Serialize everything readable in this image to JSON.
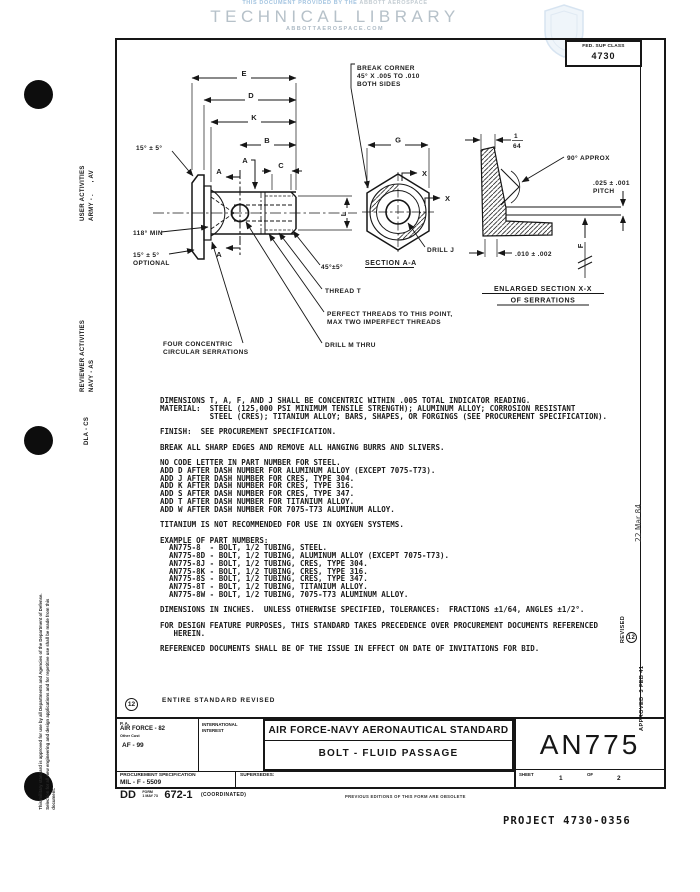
{
  "watermark": {
    "provided_prefix": "THIS DOCUMENT PROVIDED BY THE",
    "provided_brand": "ABBOTT AEROSPACE",
    "title": "TECHNICAL LIBRARY",
    "url": "ABBOTTAEROSPACE.COM"
  },
  "fed_class": {
    "label": "FED. SUP CLASS",
    "value": "4730"
  },
  "drawing": {
    "dims": {
      "e": "E",
      "d": "D",
      "k": "K",
      "b": "B",
      "a": "A",
      "c": "C",
      "g": "G",
      "l": "L",
      "f": "F",
      "x": "X",
      "frac_num": "1",
      "frac_den": "64"
    },
    "callouts": {
      "angle_head": "15° ± 5°",
      "angle_min": "118° MIN",
      "angle_opt1": "15° ± 5°",
      "angle_opt2": "OPTIONAL",
      "serr1": "FOUR CONCENTRIC",
      "serr2": "CIRCULAR SERRATIONS",
      "drill_m": "DRILL  M THRU",
      "perfect1": "PERFECT THREADS TO THIS POINT,",
      "perfect2": "MAX TWO IMPERFECT THREADS",
      "thread_t": "THREAD T",
      "tip_chamfer": "45°±5°",
      "section_a_label": "A",
      "section_aa": "SECTION A-A",
      "drill_j": "DRILL J",
      "break1": "BREAK CORNER",
      "break2": "45° X .005 TO .010",
      "break3": "BOTH SIDES",
      "approx": "90° APPROX",
      "pitch1": ".025 ± .001",
      "pitch2": "PITCH",
      "serr_w": ".010 ± .002",
      "enlarged1": "ENLARGED SECTION X-X",
      "enlarged2": "OF SERRATIONS"
    }
  },
  "notes_text": "DIMENSIONS T, A, F, AND J SHALL BE CONCENTRIC WITHIN .005 TOTAL INDICATOR READING.\nMATERIAL:  STEEL (125,000 PSI MINIMUM TENSILE STRENGTH); ALUMINUM ALLOY; CORROSION RESISTANT\n           STEEL (CRES); TITANIUM ALLOY; BARS, SHAPES, OR FORGINGS (SEE PROCUREMENT SPECIFICATION).\n\nFINISH:  SEE PROCUREMENT SPECIFICATION.\n\nBREAK ALL SHARP EDGES AND REMOVE ALL HANGING BURRS AND SLIVERS.\n\nNO CODE LETTER IN PART NUMBER FOR STEEL.\nADD D AFTER DASH NUMBER FOR ALUMINUM ALLOY (EXCEPT 7075-T73).\nADD J AFTER DASH NUMBER FOR CRES, TYPE 304.\nADD K AFTER DASH NUMBER FOR CRES, TYPE 316.\nADD S AFTER DASH NUMBER FOR CRES, TYPE 347.\nADD T AFTER DASH NUMBER FOR TITANIUM ALLOY.\nADD W AFTER DASH NUMBER FOR 7075-T73 ALUMINUM ALLOY.\n\nTITANIUM IS NOT RECOMMENDED FOR USE IN OXYGEN SYSTEMS.\n\nEXAMPLE OF PART NUMBERS:\n  AN775-8  - BOLT, 1/2 TUBING, STEEL.\n  AN775-8D - BOLT, 1/2 TUBING, ALUMINUM ALLOY (EXCEPT 7075-T73).\n  AN775-8J - BOLT, 1/2 TUBING, CRES, TYPE 304.\n  AN775-8K - BOLT, 1/2 TUBING, CRES, TYPE 316.\n  AN775-8S - BOLT, 1/2 TUBING, CRES, TYPE 347.\n  AN775-8T - BOLT, 1/2 TUBING, TITANIUM ALLOY.\n  AN775-8W - BOLT, 1/2 TUBING, 7075-T73 ALUMINUM ALLOY.\n\nDIMENSIONS IN INCHES.  UNLESS OTHERWISE SPECIFIED, TOLERANCES:  FRACTIONS ±1/64, ANGLES ±1/2°.\n\nFOR DESIGN FEATURE PURPOSES, THIS STANDARD TAKES PRECEDENCE OVER PROCUREMENT DOCUMENTS REFERENCED\n   HEREIN.\n\nREFERENCED DOCUMENTS SHALL BE OF THE ISSUE IN EFFECT ON DATE OF INVITATIONS FOR BID.",
  "revision_note": {
    "number": "12",
    "text": "ENTIRE STANDARD REVISED"
  },
  "title_block": {
    "pa_label": "P. A.",
    "pa_value": "AIR FORCE - 82",
    "other_label": "Other Cust",
    "other_value": "AF - 99",
    "intl1": "INTERNATIONAL",
    "intl2": "INTEREST",
    "standard": "AIR FORCE-NAVY AERONAUTICAL STANDARD",
    "part": "BOLT - FLUID PASSAGE",
    "number": "AN775",
    "sheet_label": "SHEET",
    "sheet": "1",
    "of_label": "OF",
    "total": "2",
    "proc_label": "PROCUREMENT SPECIFICATION",
    "proc_value": "MIL - F - 5509",
    "supersedes": "SUPERSEDES:"
  },
  "footer": {
    "dd": "DD",
    "form_line1": "FORM",
    "form_line2": "1 MAY 73",
    "form_num": "672-1",
    "coordinated": "(COORDINATED)",
    "previous": "PREVIOUS EDITIONS OF THIS FORM ARE OBSOLETE",
    "project": "PROJECT 4730-0356"
  },
  "margins": {
    "user": "USER ACTIVITIES\nARMY - .      , AV",
    "reviewer": "REVIEWER ACTIVITIES\nNAVY - AS",
    "dla": "DLA - CS",
    "statement": "This military standard is approved for use by all Departments and Agencies of the Department of Defense.\nSelection for all new engineering and design applications and for repetitive use shall be made from this\ndocument.",
    "approved": "APPROVED  3 FEB 41",
    "revised_label": "REVISED",
    "revised_num": "12",
    "rev_date": "22 Mar 84"
  }
}
